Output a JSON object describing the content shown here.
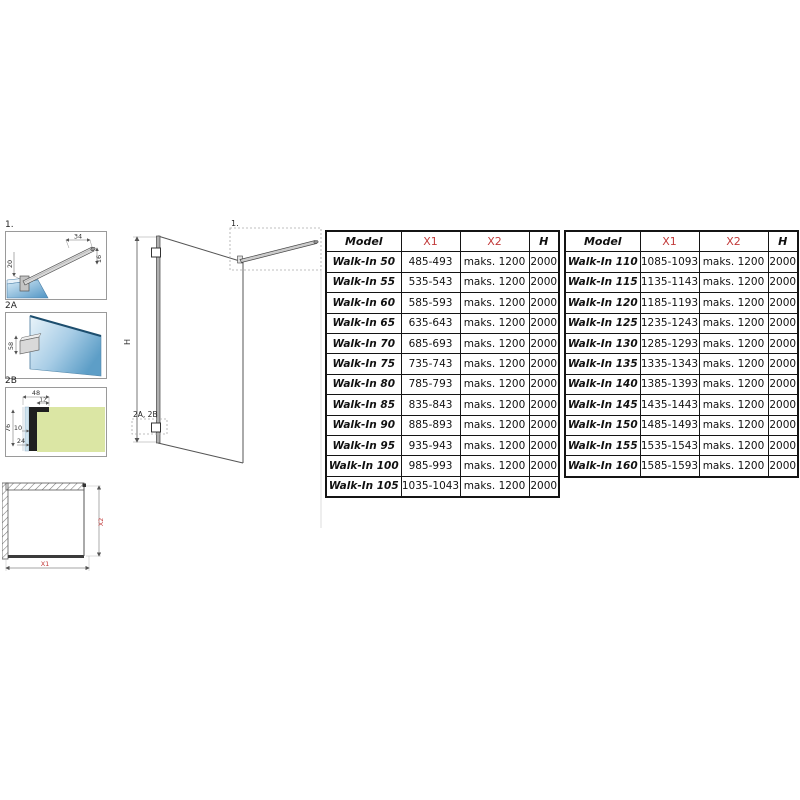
{
  "colors": {
    "accent_red": "#c23b3b",
    "glass_blue_light": "#eaf4fa",
    "glass_blue_dark": "#5d9ec7",
    "wall_green": "#dbe6a4",
    "table_border": "#141414"
  },
  "diagrams": {
    "detail1": {
      "label": "1.",
      "dim_top": "34",
      "dim_right": "16",
      "dim_left": "20"
    },
    "detail2a": {
      "label": "2A",
      "dim_clamp": "58"
    },
    "detail2b": {
      "label": "2B",
      "dim_width": "48",
      "dim_step": "12",
      "dim_height": "76",
      "dim_gap": "10",
      "dim_bottom": "24"
    },
    "plan": {
      "dim_x1": "X1",
      "dim_x2": "X2"
    },
    "elevation": {
      "dim_h": "H",
      "ref_detail1": "1.",
      "ref_detail2": "2A, 2B"
    }
  },
  "tables": [
    {
      "headers": [
        "Model",
        "X1",
        "X2",
        "H"
      ],
      "rows": [
        [
          "Walk-In 50",
          "485-493",
          "maks. 1200",
          "2000"
        ],
        [
          "Walk-In 55",
          "535-543",
          "maks. 1200",
          "2000"
        ],
        [
          "Walk-In 60",
          "585-593",
          "maks. 1200",
          "2000"
        ],
        [
          "Walk-In 65",
          "635-643",
          "maks. 1200",
          "2000"
        ],
        [
          "Walk-In 70",
          "685-693",
          "maks. 1200",
          "2000"
        ],
        [
          "Walk-In 75",
          "735-743",
          "maks. 1200",
          "2000"
        ],
        [
          "Walk-In 80",
          "785-793",
          "maks. 1200",
          "2000"
        ],
        [
          "Walk-In 85",
          "835-843",
          "maks. 1200",
          "2000"
        ],
        [
          "Walk-In 90",
          "885-893",
          "maks. 1200",
          "2000"
        ],
        [
          "Walk-In 95",
          "935-943",
          "maks. 1200",
          "2000"
        ],
        [
          "Walk-In 100",
          "985-993",
          "maks. 1200",
          "2000"
        ],
        [
          "Walk-In 105",
          "1035-1043",
          "maks. 1200",
          "2000"
        ]
      ]
    },
    {
      "headers": [
        "Model",
        "X1",
        "X2",
        "H"
      ],
      "rows": [
        [
          "Walk-In 110",
          "1085-1093",
          "maks. 1200",
          "2000"
        ],
        [
          "Walk-In 115",
          "1135-1143",
          "maks. 1200",
          "2000"
        ],
        [
          "Walk-In 120",
          "1185-1193",
          "maks. 1200",
          "2000"
        ],
        [
          "Walk-In 125",
          "1235-1243",
          "maks. 1200",
          "2000"
        ],
        [
          "Walk-In 130",
          "1285-1293",
          "maks. 1200",
          "2000"
        ],
        [
          "Walk-In 135",
          "1335-1343",
          "maks. 1200",
          "2000"
        ],
        [
          "Walk-In 140",
          "1385-1393",
          "maks. 1200",
          "2000"
        ],
        [
          "Walk-In 145",
          "1435-1443",
          "maks. 1200",
          "2000"
        ],
        [
          "Walk-In 150",
          "1485-1493",
          "maks. 1200",
          "2000"
        ],
        [
          "Walk-In 155",
          "1535-1543",
          "maks. 1200",
          "2000"
        ],
        [
          "Walk-In 160",
          "1585-1593",
          "maks. 1200",
          "2000"
        ]
      ]
    }
  ]
}
